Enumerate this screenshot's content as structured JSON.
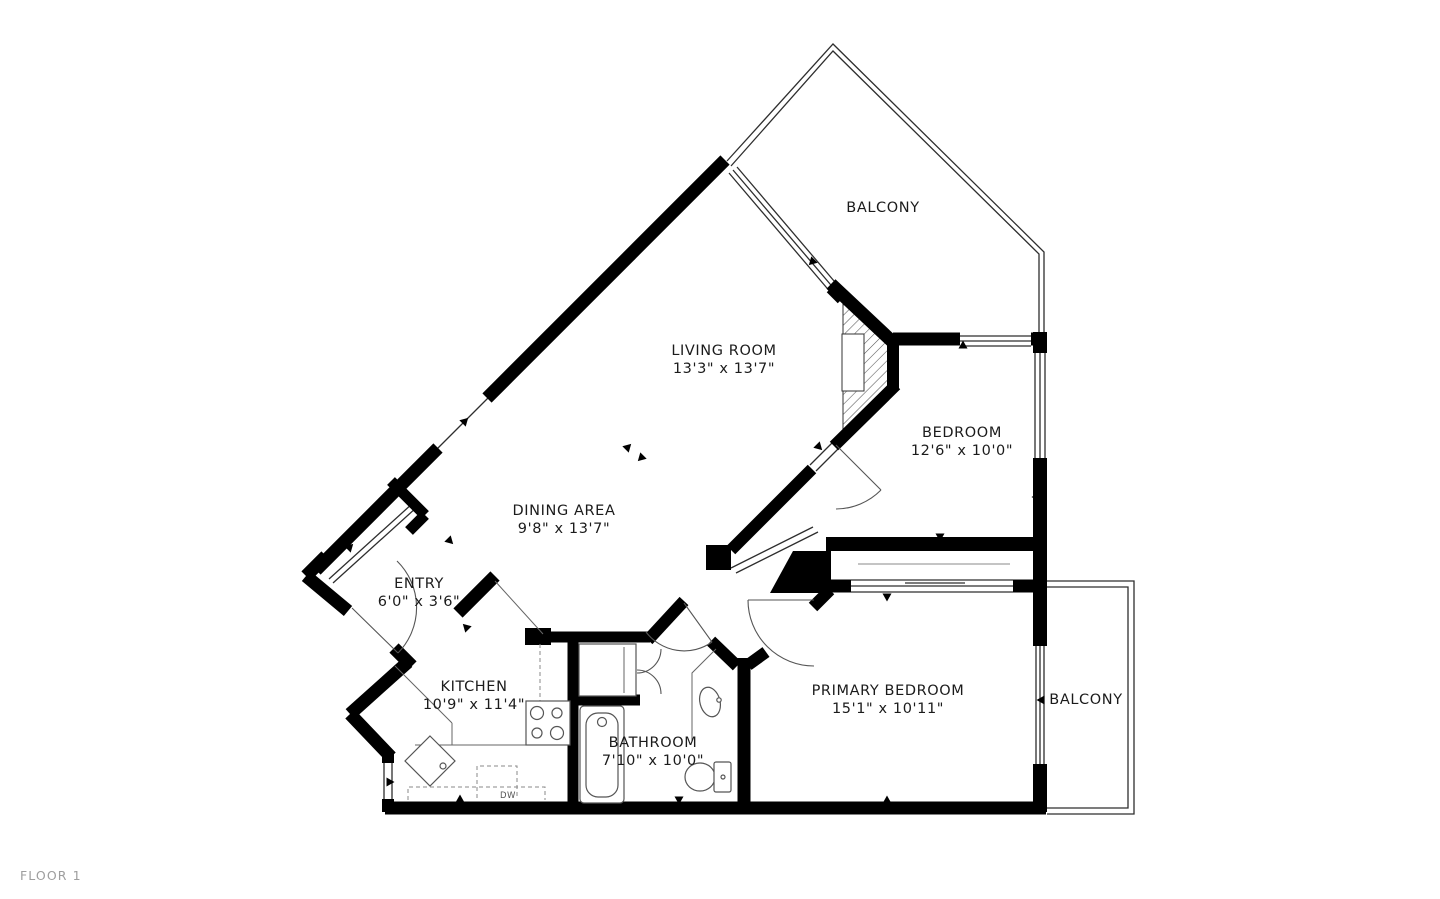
{
  "floor_plan": {
    "floor_label": "FLOOR 1",
    "rooms": [
      {
        "id": "balcony-top",
        "name": "BALCONY",
        "dims": ""
      },
      {
        "id": "living-room",
        "name": "LIVING ROOM",
        "dims": "13'3\" x 13'7\""
      },
      {
        "id": "bedroom",
        "name": "BEDROOM",
        "dims": "12'6\" x 10'0\""
      },
      {
        "id": "dining-area",
        "name": "DINING AREA",
        "dims": "9'8\" x 13'7\""
      },
      {
        "id": "entry",
        "name": "ENTRY",
        "dims": "6'0\" x 3'6\""
      },
      {
        "id": "kitchen",
        "name": "KITCHEN",
        "dims": "10'9\" x 11'4\""
      },
      {
        "id": "bathroom",
        "name": "BATHROOM",
        "dims": "7'10\" x 10'0\""
      },
      {
        "id": "primary-bedroom",
        "name": "PRIMARY BEDROOM",
        "dims": "15'1\" x 10'11\""
      },
      {
        "id": "balcony-right",
        "name": "BALCONY",
        "dims": ""
      }
    ],
    "appliance_labels": {
      "dishwasher": "DW"
    },
    "colors": {
      "background": "#ffffff",
      "wall": "#000000",
      "thin_line": "#2e2e2e",
      "fixture_line": "#555555",
      "label_text": "#1b1b1b",
      "floor_label_text": "#9e9e9e"
    }
  }
}
